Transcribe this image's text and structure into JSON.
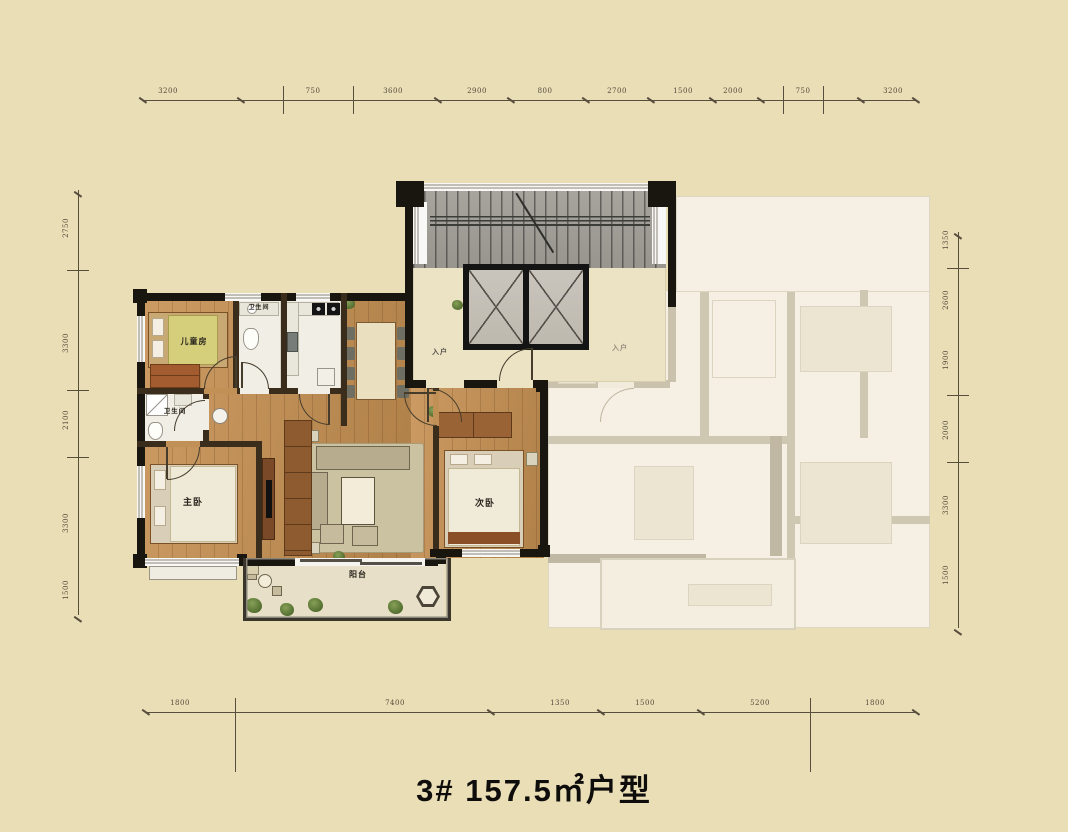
{
  "title": "3# 157.5㎡户型",
  "colors": {
    "background": "#eadeb7",
    "wall": "#19150f",
    "wood_floor": "#c19057",
    "tile_floor": "#f1eee5",
    "stair_gray": "#a09e97",
    "faded_unit": "#f8f5ed",
    "plant_green": "#5e7d3d",
    "blanket_yellow": "#d5cf7c"
  },
  "rooms": {
    "children_bedroom": {
      "label": "儿童房"
    },
    "bath_north": {
      "label": "卫生间"
    },
    "bath_west": {
      "label": "卫生间"
    },
    "master_bedroom": {
      "label": "主卧"
    },
    "secondary_bedroom": {
      "label": "次卧"
    },
    "balcony": {
      "label": "阳台"
    },
    "corridor": {
      "entry_left": "入户",
      "entry_right": "入户"
    }
  },
  "dimensions": {
    "top": {
      "y": 100,
      "x": 78,
      "labels": [
        [
          168,
          "3200"
        ],
        [
          313,
          "750"
        ],
        [
          393,
          "3600"
        ],
        [
          477,
          "2900"
        ],
        [
          545,
          "800"
        ],
        [
          617,
          "2700"
        ],
        [
          683,
          "1500"
        ],
        [
          733,
          "2000"
        ],
        [
          803,
          "750"
        ],
        [
          893,
          "3200"
        ]
      ],
      "major": [
        283,
        353,
        783,
        823
      ],
      "minor": [
        142,
        240,
        437,
        510,
        585,
        650,
        712,
        760,
        860,
        915
      ]
    },
    "bottom": {
      "y": 712,
      "x": 78,
      "labels": [
        [
          180,
          "1800"
        ],
        [
          395,
          "7400"
        ],
        [
          560,
          "1350"
        ],
        [
          645,
          "1500"
        ],
        [
          760,
          "5200"
        ],
        [
          875,
          "1800"
        ]
      ],
      "major": [
        235,
        810
      ],
      "minor": [
        145,
        490,
        600,
        700,
        915
      ]
    },
    "left": {
      "x": 78,
      "labels": [
        [
          228,
          "2750"
        ],
        [
          343,
          "3300"
        ],
        [
          420,
          "2100"
        ],
        [
          523,
          "3300"
        ],
        [
          590,
          "1500"
        ]
      ],
      "major": [
        270,
        390,
        457
      ],
      "minor": [
        190,
        615
      ]
    },
    "right": {
      "x": 958,
      "labels": [
        [
          240,
          "1350"
        ],
        [
          300,
          "2600"
        ],
        [
          360,
          "1900"
        ],
        [
          430,
          "2000"
        ],
        [
          505,
          "3300"
        ],
        [
          575,
          "1500"
        ]
      ],
      "major": [
        268,
        395,
        462
      ],
      "minor": [
        232,
        628
      ]
    }
  }
}
